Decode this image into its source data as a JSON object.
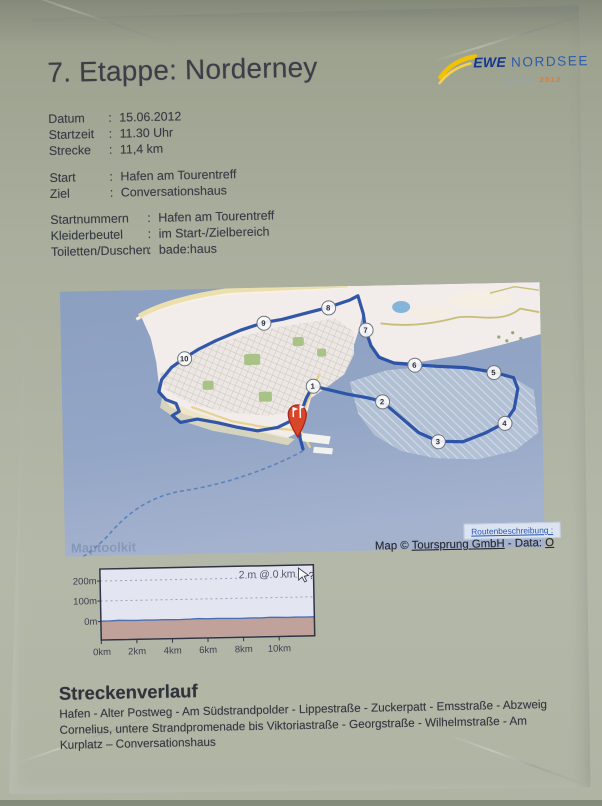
{
  "page": {
    "title": "7. Etappe: Norderney",
    "colon": ":"
  },
  "logo": {
    "brand": "EWE",
    "name": "NORDSEE",
    "sub": "LAUF",
    "year": "2012",
    "colors": {
      "brand_blue": "#14368c",
      "name_blue": "#2d5ca8",
      "swoosh_yellow": "#f2c200",
      "year_orange": "#e8762a"
    }
  },
  "details": {
    "rows": [
      {
        "label": "Datum",
        "value": "15.06.2012"
      },
      {
        "label": "Startzeit",
        "value": "11.30 Uhr"
      },
      {
        "label": "Strecke",
        "value": "11,4 km"
      }
    ]
  },
  "course": {
    "rows": [
      {
        "label": "Start",
        "value": "Hafen am Tourentreff"
      },
      {
        "label": "Ziel",
        "value": "Conversationshaus"
      }
    ]
  },
  "logistics": {
    "rows": [
      {
        "label": "Startnummern",
        "value": "Hafen am Tourentreff"
      },
      {
        "label": "Kleiderbeutel",
        "value": "im Start-/Zielbereich"
      },
      {
        "label": "Toiletten/Duschen",
        "value": "bade:haus"
      }
    ]
  },
  "map": {
    "watermark": "Maptoolkit",
    "route_link": "Routenbeschreibung :",
    "attribution": {
      "prefix": "Map © ",
      "link1": "Toursprung GmbH",
      "mid": " - Data: ",
      "link2": "O"
    },
    "markers": [
      {
        "label": "1"
      },
      {
        "label": "2"
      },
      {
        "label": "3"
      },
      {
        "label": "4"
      },
      {
        "label": "5"
      },
      {
        "label": "6"
      },
      {
        "label": "7"
      },
      {
        "label": "8"
      },
      {
        "label": "9"
      },
      {
        "label": "10"
      }
    ],
    "colors": {
      "water": "#8fa2c2",
      "land": "#f2ecea",
      "route": "#274fa5",
      "flats": "#b5c3d6",
      "beach": "#ecdfae",
      "pin_red": "#d9472b",
      "park_green": "#a9c386"
    }
  },
  "chart_data": {
    "type": "area",
    "title": "",
    "tooltip": "2 m @ 0 km",
    "cursor_help": "?",
    "yticks": [
      "200m",
      "100m",
      "0m"
    ],
    "xticks": [
      "0km",
      "2km",
      "4km",
      "6km",
      "8km",
      "10km"
    ],
    "ylim": [
      0,
      250
    ],
    "xlim_km": [
      0,
      12
    ],
    "grid": "dashed horizontal lines at 100m and 200m",
    "legend_position": "none",
    "x_km": [
      0,
      0.5,
      1,
      1.5,
      2,
      2.5,
      3,
      3.5,
      4,
      4.5,
      5,
      5.5,
      6,
      6.5,
      7,
      7.5,
      8,
      8.5,
      9,
      9.5,
      10,
      10.5,
      11,
      11.5,
      12
    ],
    "elevation_m": [
      2,
      2,
      4,
      3,
      2,
      3,
      2,
      3,
      2,
      2,
      3,
      5,
      3,
      4,
      3,
      2,
      2,
      3,
      2,
      4,
      3,
      2,
      3,
      2,
      2
    ],
    "colors": {
      "bg": "#e3e6f1",
      "below_fill": "#c1a29a",
      "line": "#4a6fb5",
      "frame": "#2e3444"
    }
  },
  "route_description": {
    "heading": "Streckenverlauf",
    "text": "Hafen - Alter Postweg - Am Südstrandpolder - Lippestraße - Zuckerpatt - Emsstraße - Abzweig Cornelius, untere Strandpromenade bis Viktoriastraße - Georgstraße - Wilhelmstraße - Am Kurplatz – Conversationshaus"
  }
}
